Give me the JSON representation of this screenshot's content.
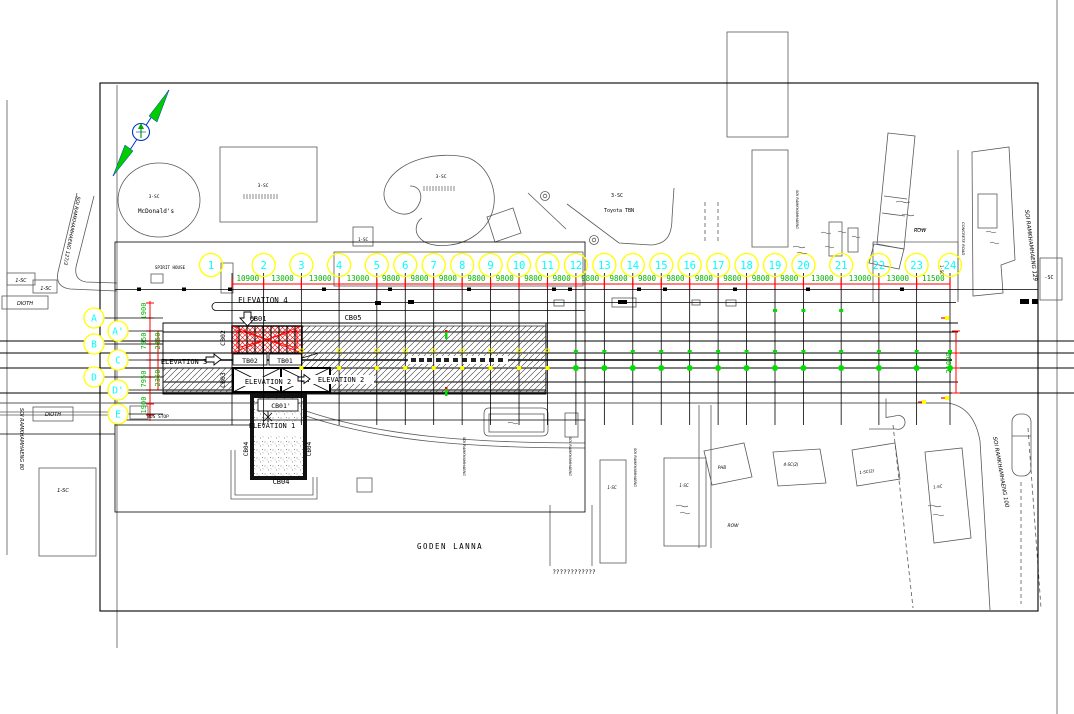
{
  "palette": {
    "yellow": "#ffff00",
    "cyan": "#00ffff",
    "green_text": "#00b400",
    "green_marker": "#00dd00",
    "red": "#ff0000",
    "black": "#000000",
    "site_gray": "#5a5a5a",
    "background": "#ffffff"
  },
  "grid": {
    "column_labels": [
      "1",
      "2",
      "3",
      "4",
      "5",
      "6",
      "7",
      "8",
      "9",
      "10",
      "11",
      "12",
      "13",
      "14",
      "15",
      "16",
      "17",
      "18",
      "19",
      "20",
      "21",
      "22",
      "23",
      "24"
    ],
    "column_spacings_mm": [
      "10900",
      "13000",
      "13000",
      "13000",
      "9800",
      "9800",
      "9800",
      "9800",
      "9800",
      "9800",
      "9800",
      "9800",
      "9800",
      "9800",
      "9800",
      "9800",
      "9800",
      "9800",
      "9800",
      "13000",
      "13000",
      "13000",
      "11500"
    ],
    "row_labels": [
      "A",
      "A'",
      "B",
      "C",
      "D",
      "D'",
      "E"
    ],
    "left_dimensions_mm": [
      "1900",
      "7950",
      "2350",
      "2350",
      "7950",
      "1900"
    ],
    "right_overall_dimension_mm": "21000"
  },
  "labels": {
    "goden_lanna": "GODEN LANNA"
  },
  "annotations": [
    {
      "name": "label-elevation-4",
      "text": "ELEVATION 4",
      "x": 263,
      "y": 303,
      "size": 7.5
    },
    {
      "name": "label-cb01",
      "text": "CB01",
      "x": 258,
      "y": 321,
      "size": 7
    },
    {
      "name": "label-cb05",
      "text": "CB05",
      "x": 353,
      "y": 320,
      "size": 7
    },
    {
      "name": "label-cb02",
      "text": "CB02",
      "x": 225,
      "y": 338,
      "size": 6.5,
      "rot": -90
    },
    {
      "name": "label-tb02",
      "text": "TB02",
      "x": 250,
      "y": 363,
      "size": 6.5
    },
    {
      "name": "label-tb01",
      "text": "TB01",
      "x": 285,
      "y": 363,
      "size": 6.5
    },
    {
      "name": "label-elevation-3",
      "text": "ELEVATION 3",
      "x": 184,
      "y": 364,
      "size": 7
    },
    {
      "name": "label-elevation-2a",
      "text": "ELEVATION 2",
      "x": 268,
      "y": 384,
      "size": 7
    },
    {
      "name": "label-elevation-2b",
      "text": "ELEVATION 2",
      "x": 341,
      "y": 382,
      "size": 7
    },
    {
      "name": "label-cb03",
      "text": "CB03",
      "x": 225,
      "y": 380,
      "size": 6.5,
      "rot": -90
    },
    {
      "name": "label-cb01-prime",
      "text": "CB01'",
      "x": 281,
      "y": 408,
      "size": 6.5
    },
    {
      "name": "label-elevation-1",
      "text": "ELEVATION 1",
      "x": 272,
      "y": 428,
      "size": 7
    },
    {
      "name": "label-cb04-left",
      "text": "CB04",
      "x": 248,
      "y": 449,
      "size": 6,
      "rot": -90
    },
    {
      "name": "label-cb04-right",
      "text": "CB04",
      "x": 311,
      "y": 449,
      "size": 6,
      "rot": -90
    },
    {
      "name": "label-cb04-bottom",
      "text": "CB04",
      "x": 281,
      "y": 484,
      "size": 7
    },
    {
      "name": "label-spirit-house",
      "text": "SPIRIT HOUSE",
      "x": 170,
      "y": 269,
      "size": 4.2
    },
    {
      "name": "label-bus-stop",
      "text": "BUS STOP",
      "x": 158,
      "y": 418,
      "size": 4.5
    },
    {
      "name": "label-thai-text",
      "text": "????????????",
      "x": 574,
      "y": 574,
      "size": 6
    },
    {
      "name": "label-mcdonalds",
      "text": "McDonald's",
      "x": 156,
      "y": 213,
      "size": 6
    },
    {
      "name": "label-parcel-3sc-mcd",
      "text": "3-SC",
      "x": 154,
      "y": 198,
      "size": 4.5
    },
    {
      "name": "label-parcel-3sc-a",
      "text": "3-SC",
      "x": 263,
      "y": 187,
      "size": 4.5
    },
    {
      "name": "label-parcel-3sc-b",
      "text": "3-SC",
      "x": 441,
      "y": 178,
      "size": 4.5
    },
    {
      "name": "label-parcel-3sc-c",
      "text": "3-SC",
      "x": 617,
      "y": 197,
      "size": 5
    },
    {
      "name": "label-toyota-tbn",
      "text": "Toyota TBN",
      "x": 619,
      "y": 212,
      "size": 5
    },
    {
      "name": "label-parcel-1sc-top",
      "text": "1-SC",
      "x": 363,
      "y": 241,
      "size": 4.2
    },
    {
      "name": "label-parcel-1sc-left1",
      "text": "1-SC",
      "x": 21,
      "y": 282,
      "size": 4.8,
      "italic": 1
    },
    {
      "name": "label-parcel-1sc-left2",
      "text": "1-SC",
      "x": 46,
      "y": 290,
      "size": 4.8,
      "italic": 1
    },
    {
      "name": "label-dioth-1",
      "text": "DIOTH",
      "x": 25,
      "y": 305,
      "size": 5,
      "italic": 1
    },
    {
      "name": "label-dioth-2",
      "text": "DIOTH",
      "x": 53,
      "y": 416,
      "size": 5,
      "italic": 1
    },
    {
      "name": "label-parcel-1sc-left3",
      "text": "1-SC",
      "x": 63,
      "y": 492,
      "size": 5,
      "italic": 1
    },
    {
      "name": "road-soi-ramkhamhaeng-127",
      "text": "SOI RAMKHAMHAENG 127/3",
      "x": 77,
      "y": 196,
      "size": 5,
      "italic": 1,
      "rot": 101,
      "anchor": "start"
    },
    {
      "name": "road-soi-ramkhamhaeng-80",
      "text": "SOI RAMKHAMHAENG 80",
      "x": 20,
      "y": 408,
      "size": 5,
      "italic": 1,
      "rot": 90,
      "anchor": "start"
    },
    {
      "name": "road-soi-ramkhamhaeng-129",
      "text": "SOI RAMKHAMHAENG 129",
      "x": 1025,
      "y": 210,
      "size": 5.5,
      "italic": 1,
      "rot": 83,
      "anchor": "start"
    },
    {
      "name": "road-soi-ramkhamhaeng-100",
      "text": "SOI RAMKHAMHAENG 100",
      "x": 993,
      "y": 437,
      "size": 5.5,
      "italic": 1,
      "rot": 80,
      "anchor": "start"
    },
    {
      "name": "road-concrete-road",
      "text": "CONCRETE ROAD",
      "x": 962,
      "y": 222,
      "size": 3.8,
      "italic": 1,
      "rot": 90,
      "anchor": "start"
    },
    {
      "name": "label-row-right",
      "text": "ROW",
      "x": 920,
      "y": 232,
      "size": 5,
      "italic": 1
    },
    {
      "name": "label-row-bottom",
      "text": "ROW",
      "x": 733,
      "y": 527,
      "size": 4.5,
      "italic": 1
    },
    {
      "name": "label-parcel-1sc-mid1",
      "text": "1-SC",
      "x": 612,
      "y": 489,
      "size": 4,
      "italic": 1
    },
    {
      "name": "label-parcel-1sc-mid2",
      "text": "1-SC",
      "x": 684,
      "y": 487,
      "size": 4,
      "italic": 1
    },
    {
      "name": "label-parcel-phb",
      "text": "PHB",
      "x": 722,
      "y": 469,
      "size": 4,
      "italic": 1
    },
    {
      "name": "label-parcel-4sc2",
      "text": "4-SC(2)",
      "x": 791,
      "y": 466,
      "size": 4,
      "italic": 1
    },
    {
      "name": "label-parcel-1sc2",
      "text": "1-SC(2)",
      "x": 867,
      "y": 473,
      "size": 4,
      "italic": 1,
      "rot": -8
    },
    {
      "name": "label-parcel-1sc-br",
      "text": "1-SC",
      "x": 938,
      "y": 488,
      "size": 4,
      "italic": 1,
      "rot": -8
    },
    {
      "name": "label-parcel-sc-right",
      "text": "-SC",
      "x": 1049,
      "y": 279,
      "size": 5
    },
    {
      "name": "label-parcel-1sc-vert",
      "text": "1-SC",
      "x": 940,
      "y": 265,
      "size": 4,
      "rot": 90,
      "anchor": "start"
    },
    {
      "name": "road-soi-mid-a",
      "text": "SOI RAMKHAMHAENG",
      "x": 463,
      "y": 437,
      "size": 3.6,
      "italic": 1,
      "rot": 90,
      "anchor": "start"
    },
    {
      "name": "road-soi-mid-b",
      "text": "SOI RAMKHAMHAENG",
      "x": 569,
      "y": 437,
      "size": 3.6,
      "italic": 1,
      "rot": 90,
      "anchor": "start"
    },
    {
      "name": "road-soi-mid-c",
      "text": "SOI RAMKHAMHAENG",
      "x": 634,
      "y": 448,
      "size": 3.6,
      "italic": 1,
      "rot": 90,
      "anchor": "start"
    },
    {
      "name": "road-soi-topright",
      "text": "SOI RAMKHAMHAENG",
      "x": 796,
      "y": 190,
      "size": 3.6,
      "italic": 1,
      "rot": 90,
      "anchor": "start"
    }
  ]
}
